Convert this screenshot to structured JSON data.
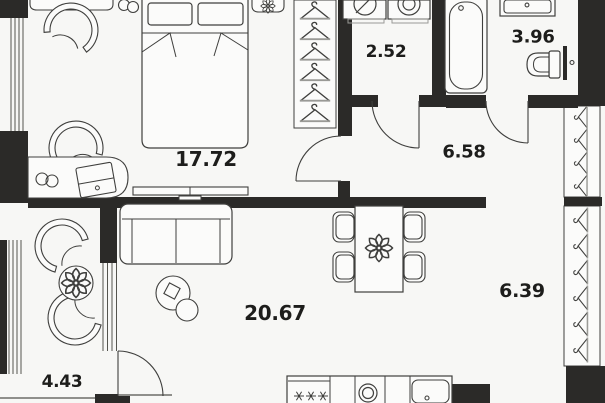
{
  "plan_title": "apartment-floor-plan",
  "colors": {
    "background": "#f7f7f5",
    "wall": "#2b2a28",
    "furniture_line": "#3f3f3d",
    "light_line": "#8f8f8b",
    "label_text": "#1d1d1b",
    "room_fill": "#fbfbfa"
  },
  "rooms": {
    "bedroom": {
      "label": "17.72"
    },
    "laundry": {
      "label": "2.52"
    },
    "bathroom": {
      "label": "3.96"
    },
    "hallway": {
      "label": "6.58"
    },
    "dressing": {
      "label": "6.39"
    },
    "living": {
      "label": "20.67"
    },
    "balcony": {
      "label": "4.43"
    }
  },
  "icons": [
    "bed",
    "pillow",
    "nightstand",
    "shelf",
    "plant-icon",
    "armchair-icon",
    "desk",
    "eyeglasses-icon",
    "laptop-icon",
    "cups-icon",
    "tv-console",
    "hanger-icon",
    "washing-machine-icon",
    "dryer-icon",
    "bathtub",
    "washbasin",
    "toilet",
    "door-swing-icon",
    "sofa",
    "coffee-table",
    "dining-table",
    "dining-chair",
    "kitchen-counter",
    "fridge-icon",
    "stove-icon",
    "kitchen-sink-icon",
    "window",
    "glazed-partition",
    "wall"
  ]
}
